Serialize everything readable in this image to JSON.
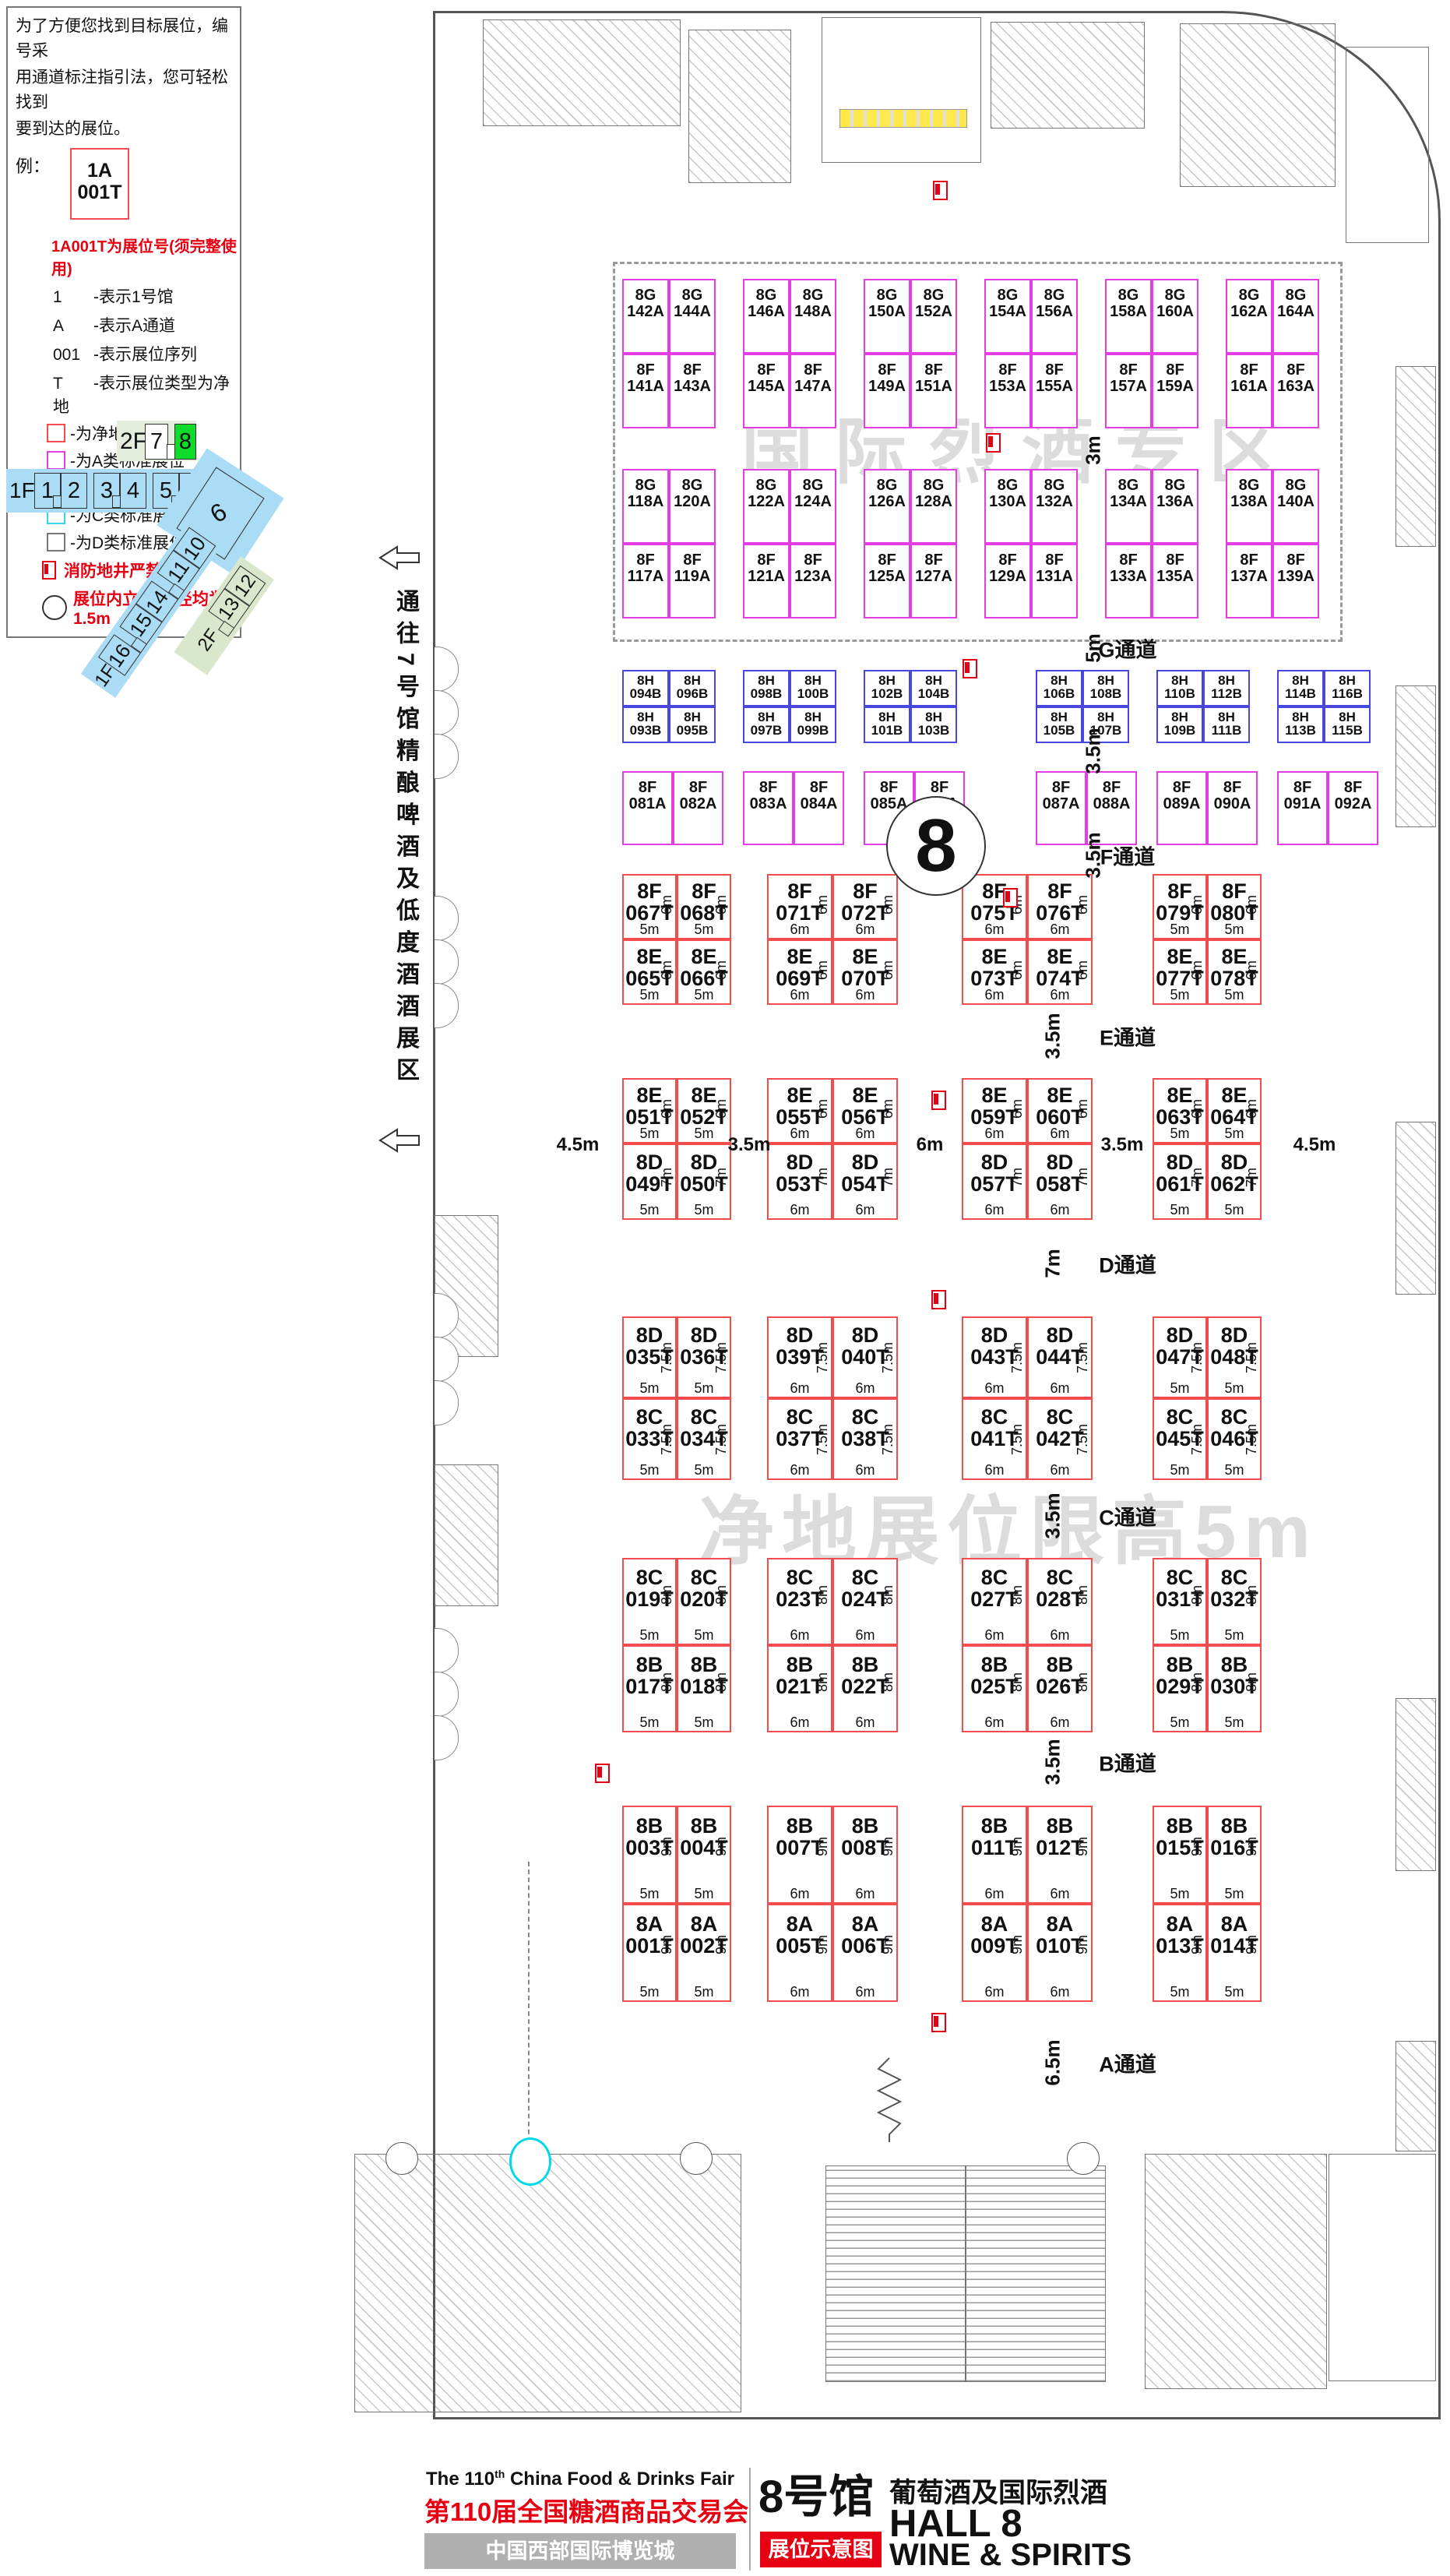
{
  "legend": {
    "intro": [
      "为了方便您找到目标展位，编号采",
      "用通道标注指引法，您可轻松找到",
      "要到达的展位。"
    ],
    "example_label": "例：",
    "example_box": [
      "1A",
      "001T"
    ],
    "headline": "1A001T为展位号(须完整使用)",
    "codes": [
      {
        "k": "1",
        "v": "-表示1号馆"
      },
      {
        "k": "A",
        "v": "-表示A通道"
      },
      {
        "k": "001",
        "v": "-表示展位序列"
      },
      {
        "k": "T",
        "v": "-表示展位类型为净地"
      }
    ],
    "swatches": [
      {
        "type": "t",
        "color": "#f24c4c",
        "label": "-为净地展位"
      },
      {
        "type": "a",
        "color": "#e33de3",
        "label": "-为A类标准展位"
      },
      {
        "type": "b",
        "color": "#4848e0",
        "label": "-为B类标准展位"
      },
      {
        "type": "c",
        "color": "#35d8e8",
        "label": "-为C类标准展位"
      },
      {
        "type": "d",
        "color": "#777777",
        "label": "-为D类标准展位"
      }
    ],
    "fire_note": "消防地井严禁遮挡",
    "pillar_note": "展位内立柱 直径均为1.5m"
  },
  "minimap": {
    "f2": {
      "label": "2F",
      "halls": [
        "7",
        "8"
      ],
      "highlight": "8",
      "highlight_color": "#0ddd2a"
    },
    "f1": {
      "label": "1F",
      "halls": [
        "1",
        "2",
        "3",
        "4",
        "5",
        "6"
      ]
    },
    "hall9": "9",
    "diag": {
      "halls": [
        "10",
        "11",
        "14",
        "15",
        "16"
      ],
      "label": "1F"
    },
    "diag2f": {
      "label": "2F",
      "halls": [
        "12",
        "13"
      ]
    },
    "blue": "#aadcf6",
    "green": "#d9e8cc"
  },
  "corridor": {
    "text": "通往7号馆精酿啤酒及低度酒酒展区"
  },
  "watermarks": {
    "spirits": "国际烈酒专区",
    "clear": "净地展位限高5m"
  },
  "hall_circle": "8",
  "spirits_zone": {
    "gap_dim": "3m",
    "row_groups": [
      {
        "top": [
          "8G142A",
          "8G144A",
          "8G146A",
          "8G148A",
          "8G150A",
          "8G152A",
          "8G154A",
          "8G156A",
          "8G158A",
          "8G160A",
          "8G162A",
          "8G164A"
        ],
        "bottom": [
          "8F141A",
          "8F143A",
          "8F145A",
          "8F147A",
          "8F149A",
          "8F151A",
          "8F153A",
          "8F155A",
          "8F157A",
          "8F159A",
          "8F161A",
          "8F163A"
        ]
      },
      {
        "top": [
          "8G118A",
          "8G120A",
          "8G122A",
          "8G124A",
          "8G126A",
          "8G128A",
          "8G130A",
          "8G132A",
          "8G134A",
          "8G136A",
          "8G138A",
          "8G140A"
        ],
        "bottom": [
          "8F117A",
          "8F119A",
          "8F121A",
          "8F123A",
          "8F125A",
          "8F127A",
          "8F129A",
          "8F131A",
          "8F133A",
          "8F135A",
          "8F137A",
          "8F139A"
        ]
      }
    ]
  },
  "h_row": {
    "gap_dim": "3.5m",
    "top": [
      "8H094B",
      "8H096B",
      "8H098B",
      "8H100B",
      "8H102B",
      "8H104B",
      "8H106B",
      "8H108B",
      "8H110B",
      "8H112B",
      "8H114B",
      "8H116B"
    ],
    "bottom": [
      "8H093B",
      "8H095B",
      "8H097B",
      "8H099B",
      "8H101B",
      "8H103B",
      "8H105B",
      "8H107B",
      "8H109B",
      "8H111B",
      "8H113B",
      "8H115B"
    ]
  },
  "fa_row": [
    "8F081A",
    "8F082A",
    "8F083A",
    "8F084A",
    "8F085A",
    "8F086A",
    "8F087A",
    "8F088A",
    "8F089A",
    "8F090A",
    "8F091A",
    "8F092A"
  ],
  "t_grid": {
    "col_dims": [
      "5m",
      "5m",
      "6m",
      "6m",
      "6m",
      "6m",
      "5m",
      "5m"
    ],
    "mid_dims": [
      "4.5m",
      "3.5m",
      "6m",
      "3.5m",
      "4.5m"
    ],
    "rows": [
      {
        "dim": "6m",
        "ids": [
          "8F067T",
          "8F068T",
          "8F071T",
          "8F072T",
          "8F075T",
          "8F076T",
          "8F079T",
          "8F080T"
        ]
      },
      {
        "dim": "6m",
        "ids": [
          "8E065T",
          "8E066T",
          "8E069T",
          "8E070T",
          "8E073T",
          "8E074T",
          "8E077T",
          "8E078T"
        ]
      },
      {
        "dim": "6m",
        "ids": [
          "8E051T",
          "8E052T",
          "8E055T",
          "8E056T",
          "8E059T",
          "8E060T",
          "8E063T",
          "8E064T"
        ]
      },
      {
        "dim": "7m",
        "ids": [
          "8D049T",
          "8D050T",
          "8D053T",
          "8D054T",
          "8D057T",
          "8D058T",
          "8D061T",
          "8D062T"
        ]
      },
      {
        "dim": "7.5m",
        "ids": [
          "8D035T",
          "8D036T",
          "8D039T",
          "8D040T",
          "8D043T",
          "8D044T",
          "8D047T",
          "8D048T"
        ]
      },
      {
        "dim": "7.5m",
        "ids": [
          "8C033T",
          "8C034T",
          "8C037T",
          "8C038T",
          "8C041T",
          "8C042T",
          "8C045T",
          "8C046T"
        ]
      },
      {
        "dim": "8m",
        "ids": [
          "8C019T",
          "8C020T",
          "8C023T",
          "8C024T",
          "8C027T",
          "8C028T",
          "8C031T",
          "8C032T"
        ]
      },
      {
        "dim": "8m",
        "ids": [
          "8B017T",
          "8B018T",
          "8B021T",
          "8B022T",
          "8B025T",
          "8B026T",
          "8B029T",
          "8B030T"
        ]
      },
      {
        "dim": "9m",
        "ids": [
          "8B003T",
          "8B004T",
          "8B007T",
          "8B008T",
          "8B011T",
          "8B012T",
          "8B015T",
          "8B016T"
        ]
      },
      {
        "dim": "9m",
        "ids": [
          "8A001T",
          "8A002T",
          "8A005T",
          "8A006T",
          "8A009T",
          "8A010T",
          "8A013T",
          "8A014T"
        ]
      }
    ]
  },
  "aisles": [
    {
      "label": "G通道",
      "dim": "5m"
    },
    {
      "label": "F通道",
      "dim": "3.5m"
    },
    {
      "label": "E通道",
      "dim": "3.5m"
    },
    {
      "label": "D通道",
      "dim": "7m"
    },
    {
      "label": "C通道",
      "dim": "3.5m"
    },
    {
      "label": "B通道",
      "dim": "3.5m"
    },
    {
      "label": "A通道",
      "dim": "6.5m"
    }
  ],
  "footer": {
    "en_title": "The 110",
    "en_sup": "th",
    "en_rest": " China Food & Drinks Fair",
    "cn_title": "第110届全国糖酒商品交易会",
    "venue": "中国西部国际博览城",
    "hall_cn": "8号馆",
    "hall_desc": "葡萄酒及国际烈酒",
    "hall_en": "HALL 8",
    "badge": "展位示意图",
    "hall_sub": "WINE & SPIRITS",
    "accent_red": "#e60012"
  }
}
